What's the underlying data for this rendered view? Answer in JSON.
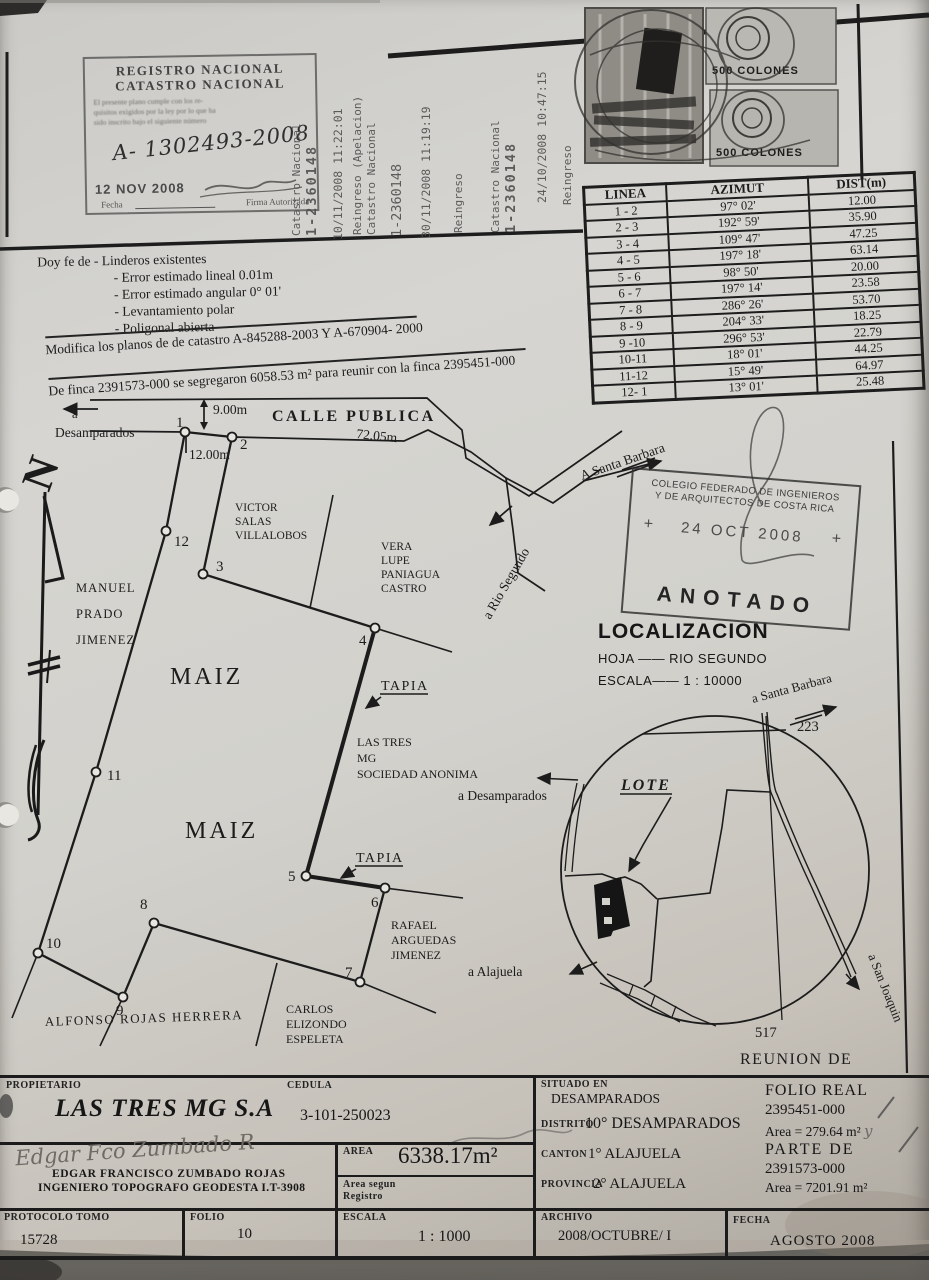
{
  "registro_stamp": {
    "line1": "REGISTRO NACIONAL",
    "line2": "CATASTRO NACIONAL",
    "fine_print": [
      "El presente plano cumple con los re-",
      "quisitos exigidos por la ley por lo que ha",
      "sido inscrito bajo el siguiente número"
    ],
    "number": "A- 1302493-2008",
    "date": "12 NOV 2008",
    "fecha_label": "Fecha",
    "firma_label": "Firma Autorizada"
  },
  "vertical_stamps": {
    "g1a": "Catastro Nacional",
    "g1b": "1-2360148",
    "g2": "10/11/2008 11:22:01",
    "g3a": "Reingreso (Apelacion)",
    "g3b": "Catastro Nacional",
    "g4": "1-2360148",
    "g5": "30/11/2008 11:19:19",
    "g6": "Reingreso",
    "g7a": "Catastro Nacional",
    "g7b": "1-2360148",
    "g8": "24/10/2008 10:47:15",
    "g9": "Reingreso"
  },
  "revenue_stamps": {
    "value1": "500 COLONES",
    "value2": "500 COLONES"
  },
  "survey_table": {
    "headers": [
      "LINEA",
      "AZIMUT",
      "DIST(m)"
    ],
    "rows": [
      [
        "1 - 2",
        "97° 02'",
        "12.00"
      ],
      [
        "2 - 3",
        "192° 59'",
        "35.90"
      ],
      [
        "3 - 4",
        "109° 47'",
        "47.25"
      ],
      [
        "4 - 5",
        "197° 18'",
        "63.14"
      ],
      [
        "5 - 6",
        "98° 50'",
        "20.00"
      ],
      [
        "6 - 7",
        "197° 14'",
        "23.58"
      ],
      [
        "7 - 8",
        "286° 26'",
        "53.70"
      ],
      [
        "8 - 9",
        "204° 33'",
        "18.25"
      ],
      [
        "9 -10",
        "296° 53'",
        "22.79"
      ],
      [
        "10-11",
        "18° 01'",
        "44.25"
      ],
      [
        "11-12",
        "15° 49'",
        "64.97"
      ],
      [
        "12- 1",
        "13° 01'",
        "25.48"
      ]
    ]
  },
  "certification": {
    "line1": "Doy fe de - Linderos existentes",
    "items": [
      "- Error estimado lineal 0.01m",
      "- Error estimado angular 0° 01'",
      "- Levantamiento polar",
      "- Poligonal abierta"
    ],
    "modifica": "Modifica los planos de de catastro A-845288-2003 Y A-670904- 2000",
    "finca": "De finca 2391573-000 se segregaron  6058.53 m² para reunir con la finca 2395451-000"
  },
  "drawing": {
    "street": "CALLE PUBLICA",
    "to_desamparados_a": "a",
    "to_desamparados": "Desamparados",
    "dim_9": "9.00m",
    "dim_72": "72.05m",
    "dim_12": "12.00m",
    "to_santa_barbara": "A Santa Barbara",
    "to_rio_segundo": "a Rio Segundo",
    "maiz": "MAIZ",
    "tapia": "TAPIA",
    "owner_lines": [
      "LAS TRES",
      "MG",
      "SOCIEDAD ANONIMA"
    ],
    "neighbors": {
      "victor": [
        "VICTOR",
        "SALAS",
        "VILLALOBOS"
      ],
      "vera": [
        "VERA",
        "LUPE",
        "PANIAGUA",
        "CASTRO"
      ],
      "manuel": [
        "MANUEL",
        "PRADO",
        "JIMENEZ"
      ],
      "rafael": [
        "RAFAEL",
        "ARGUEDAS",
        "JIMENEZ"
      ],
      "carlos": [
        "CARLOS",
        "ELIZONDO",
        "ESPELETA"
      ],
      "alfonso": "ALFONSO ROJAS HERRERA"
    },
    "points": [
      "1",
      "2",
      "3",
      "4",
      "5",
      "6",
      "7",
      "8",
      "9",
      "10",
      "11",
      "12"
    ]
  },
  "cfia_stamp": {
    "line1": "COLEGIO FEDERADO DE INGENIEROS",
    "line2": "Y DE ARQUITECTOS DE COSTA RICA",
    "plus": "+",
    "date": "24 OCT 2008",
    "anotado": "ANOTADO"
  },
  "localizacion": {
    "title": "LOCALIZACION",
    "hoja": "HOJA —— RIO SEGUNDO",
    "escala": "ESCALA—— 1 : 10000"
  },
  "inset": {
    "lote": "LOTE",
    "route_top": "223",
    "route_bottom": "517",
    "to_santa_barbara": "a Santa Barbara",
    "to_san_joaquin": "a San Joaquin",
    "to_alajuela": "a Alajuela",
    "to_desamparados": "a Desamparados",
    "reunion": "REUNION DE"
  },
  "info": {
    "propietario_label": "PROPIETARIO",
    "propietario": "LAS TRES MG  S.A",
    "cedula_label": "CEDULA",
    "cedula": "3-101-250023",
    "signature": "Edgar Fco Zumbado R",
    "engineer1": "EDGAR FRANCISCO ZUMBADO ROJAS",
    "engineer2": "INGENIERO TOPOGRAFO GEODESTA I.T-3908",
    "area_label": "AREA",
    "area": "6338.17m²",
    "area_registro_label1": "Area segun",
    "area_registro_label2": "Registro",
    "situado_label": "SITUADO EN",
    "situado": "DESAMPARADOS",
    "distrito_label": "DISTRITO",
    "distrito": "10° DESAMPARADOS",
    "canton_label": "CANTON",
    "canton": "1° ALAJUELA",
    "provincia_label": "PROVINCIA",
    "provincia": "2° ALAJUELA",
    "folio_real_label": "FOLIO REAL",
    "folio_real": "2395451-000",
    "area1": "Area = 279.64 m²",
    "area1_suffix": "y",
    "parte_de": "PARTE DE",
    "parte_de_num": "2391573-000",
    "area2": "Area = 7201.91 m²",
    "protocolo_label": "PROTOCOLO TOMO",
    "protocolo": "15728",
    "folio_label": "FOLIO",
    "folio": "10",
    "escala_label": "ESCALA",
    "escala": "1 : 1000",
    "archivo_label": "ARCHIVO",
    "fecha_label": "FECHA",
    "archivo": "2008/OCTUBRE/ I",
    "fecha": "AGOSTO 2008"
  }
}
